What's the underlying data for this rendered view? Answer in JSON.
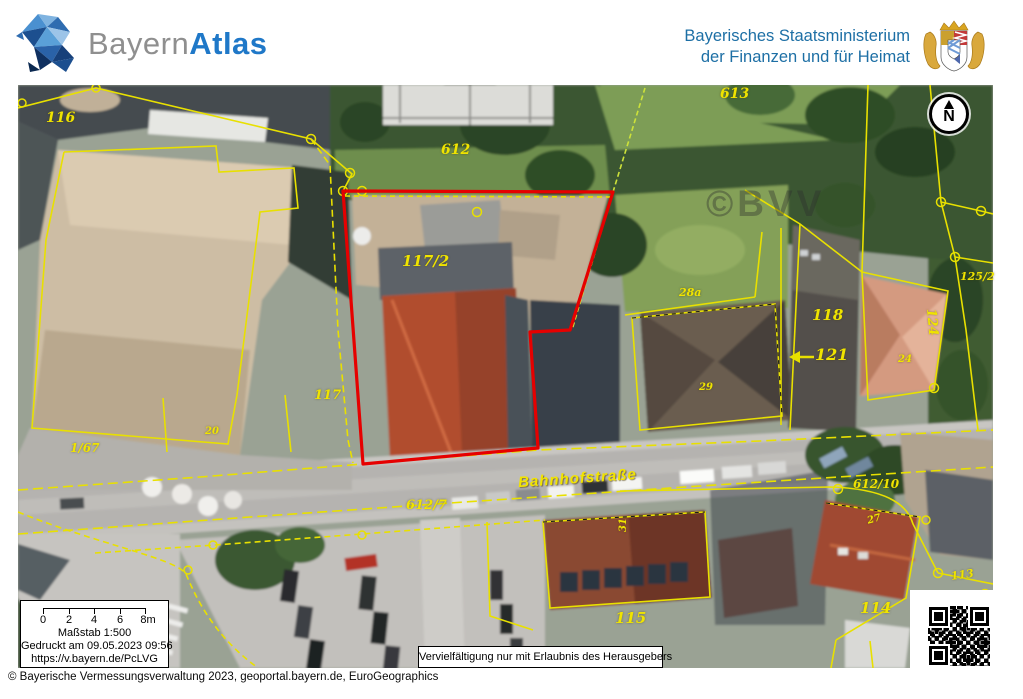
{
  "header": {
    "brand": {
      "part1": "Bayern",
      "part2": "Atlas"
    },
    "ministry": {
      "line1": "Bayerisches Staatsministerium",
      "line2": "der Finanzen und für Heimat"
    }
  },
  "map": {
    "watermark": "©BVV",
    "north_label": "N",
    "street_label": "Bahnhofstraße",
    "labels": [
      {
        "text": "116",
        "x": 46,
        "y": 110,
        "size": 14
      },
      {
        "text": "612",
        "x": 441,
        "y": 142,
        "size": 14
      },
      {
        "text": "613",
        "x": 720,
        "y": 86,
        "size": 14
      },
      {
        "text": "117/2",
        "x": 402,
        "y": 252,
        "size": 15
      },
      {
        "text": "117",
        "x": 314,
        "y": 388,
        "size": 13
      },
      {
        "text": "1/67",
        "x": 70,
        "y": 441,
        "size": 12
      },
      {
        "text": "20",
        "x": 205,
        "y": 426,
        "size": 10
      },
      {
        "text": "612/7",
        "x": 406,
        "y": 498,
        "size": 13
      },
      {
        "text": "28a",
        "x": 679,
        "y": 286,
        "size": 11
      },
      {
        "text": "29",
        "x": 699,
        "y": 382,
        "size": 10
      },
      {
        "text": "31",
        "x": 618,
        "y": 532,
        "size": 10,
        "rot": -90
      },
      {
        "text": "118",
        "x": 812,
        "y": 306,
        "size": 15
      },
      {
        "text": "121",
        "x": 815,
        "y": 345,
        "size": 16
      },
      {
        "text": "124",
        "x": 938,
        "y": 308,
        "size": 13,
        "rot": 85
      },
      {
        "text": "125/2",
        "x": 960,
        "y": 270,
        "size": 11
      },
      {
        "text": "24",
        "x": 898,
        "y": 354,
        "size": 10
      },
      {
        "text": "612/10",
        "x": 853,
        "y": 477,
        "size": 12
      },
      {
        "text": "27",
        "x": 866,
        "y": 516,
        "size": 10,
        "rot": -15
      },
      {
        "text": "115",
        "x": 615,
        "y": 609,
        "size": 15
      },
      {
        "text": "114",
        "x": 860,
        "y": 599,
        "size": 15
      },
      {
        "text": "113",
        "x": 950,
        "y": 570,
        "size": 11,
        "rot": -8
      }
    ]
  },
  "scale_box": {
    "tick_labels": [
      "0",
      "2",
      "4",
      "6",
      "8m"
    ],
    "scale": "Maßstab 1:500",
    "printed": "Gedruckt am 09.05.2023 09:56",
    "url": "https://v.bayern.de/PcLVG"
  },
  "notice": "Vervielfältigung nur mit Erlaubnis des Herausgebers",
  "footer": "© Bayerische Vermessungsverwaltung 2023, geoportal.bayern.de, EuroGeographics",
  "colors": {
    "highlight": "#e60000",
    "parcel": "#e8e000",
    "label": "#f0e400",
    "brand_blue": "#1f78c8",
    "brand_gray": "#8f8f8f",
    "ministry_blue": "#1d6fa5"
  }
}
